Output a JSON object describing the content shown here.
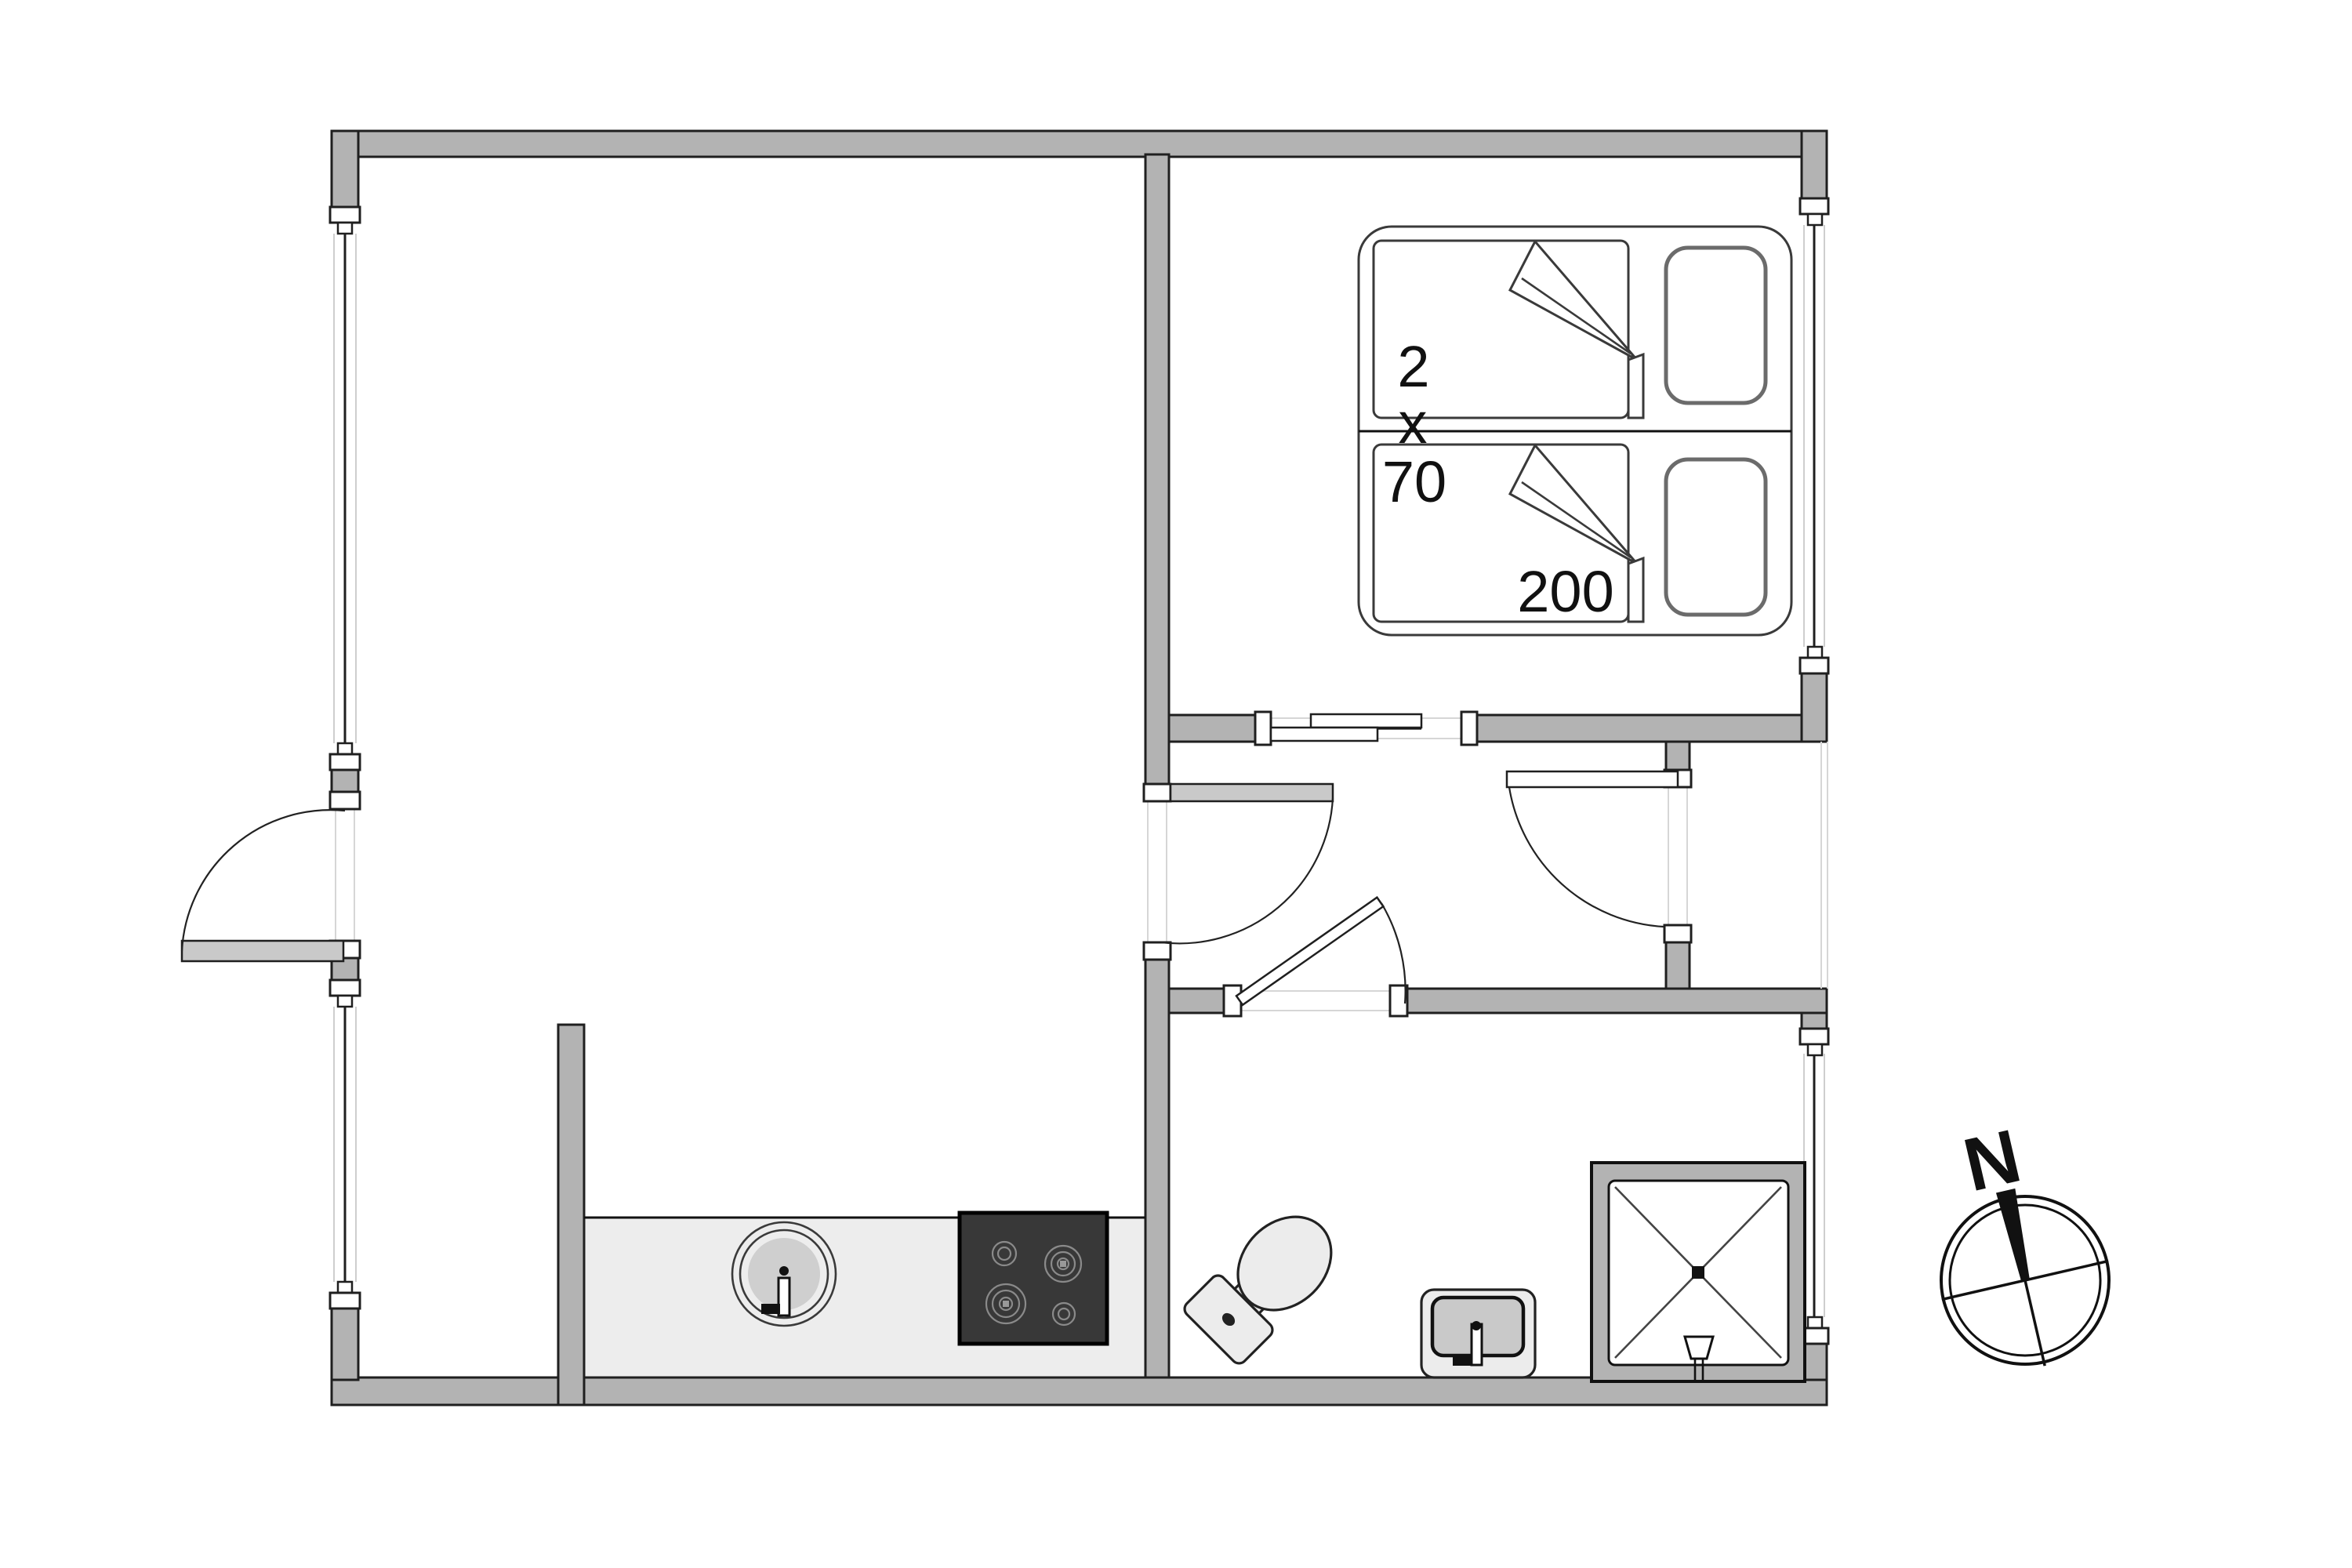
{
  "plan": {
    "bed_label": {
      "count": "2",
      "times": "x",
      "width": "70",
      "length": "200"
    },
    "compass": {
      "north": "N"
    }
  },
  "colors": {
    "wall_fill": "#b3b3b3",
    "line": "#1f1f1f",
    "floor_counter": "#ededed",
    "stove_fill": "#383838",
    "fixture_light": "#ececec",
    "fixture_mid": "#c9c9c9",
    "leaf_fill": "#c9c9c9",
    "faint": "#d6d6d6",
    "text": "#111111"
  }
}
